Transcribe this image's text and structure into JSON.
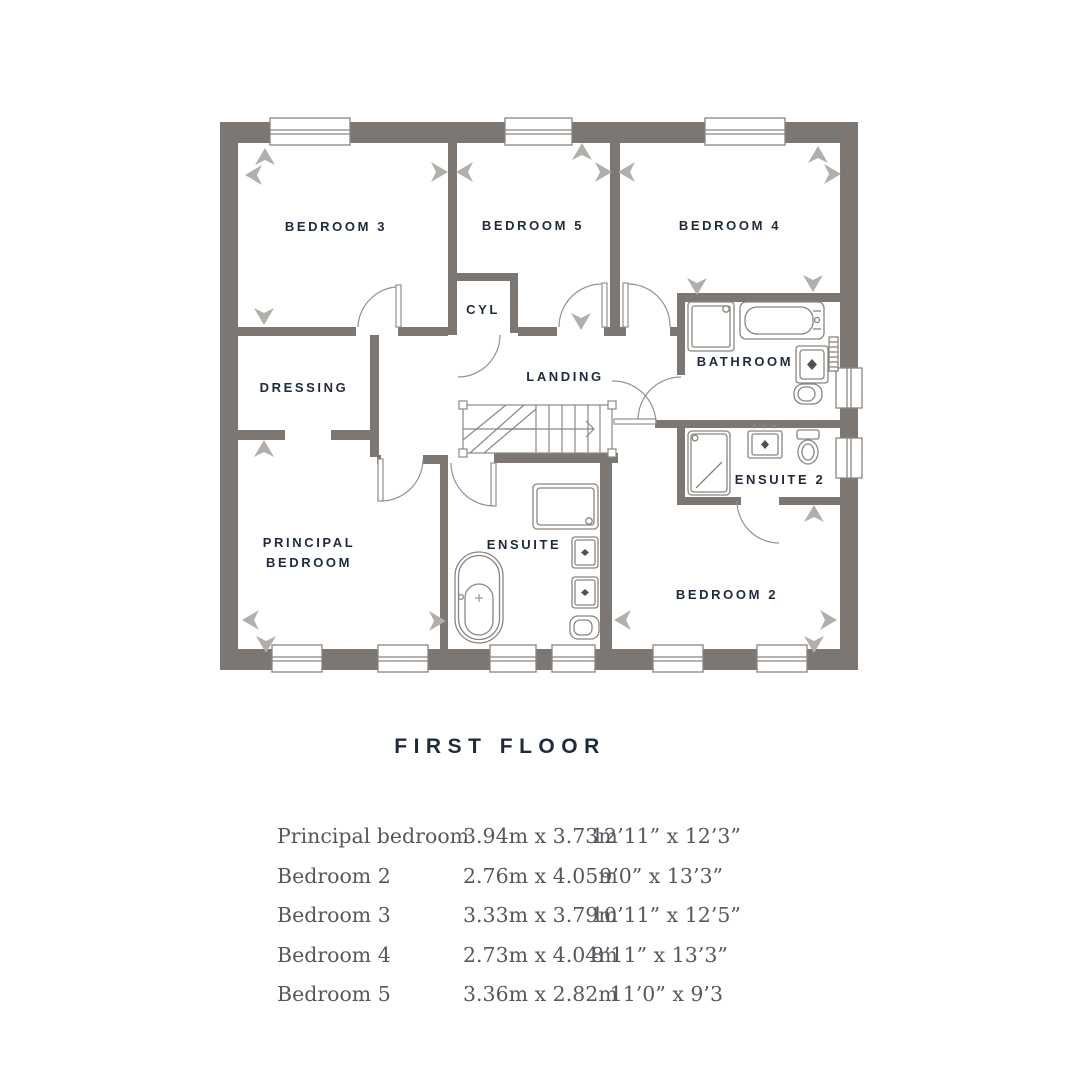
{
  "title": "FIRST FLOOR",
  "plan": {
    "labels": {
      "bedroom3": "BEDROOM 3",
      "bedroom5": "BEDROOM 5",
      "bedroom4": "BEDROOM 4",
      "cyl": "CYL",
      "landing": "LANDING",
      "bathroom": "BATHROOM",
      "dressing": "DRESSING",
      "ensuite2": "ENSUITE 2",
      "principal_line1": "PRINCIPAL",
      "principal_line2": "BEDROOM",
      "ensuite": "ENSUITE",
      "bedroom2": "BEDROOM 2"
    },
    "colors": {
      "wall": "#7c7772",
      "fixture_line": "#8a857f",
      "door_line": "#95908a",
      "label_text": "#1f2b3c",
      "chevron": "#b2aeaa"
    }
  },
  "dimensions_table": {
    "rows": [
      {
        "room": "Principal bedroom",
        "metric": "3.94m x 3.73m",
        "imperial": "12’11” x 12’3”"
      },
      {
        "room": "Bedroom 2",
        "metric": "2.76m x 4.05m",
        "imperial": "9’0” x 13’3”"
      },
      {
        "room": "Bedroom 3",
        "metric": "3.33m x 3.79m",
        "imperial": "10’11” x 12’5”"
      },
      {
        "room": "Bedroom 4",
        "metric": "2.73m x 4.04m",
        "imperial": "8’11” x 13’3”"
      },
      {
        "room": "Bedroom 5",
        "metric": "3.36m x 2.82m",
        "imperial": "11’0” x 9’3"
      }
    ]
  }
}
